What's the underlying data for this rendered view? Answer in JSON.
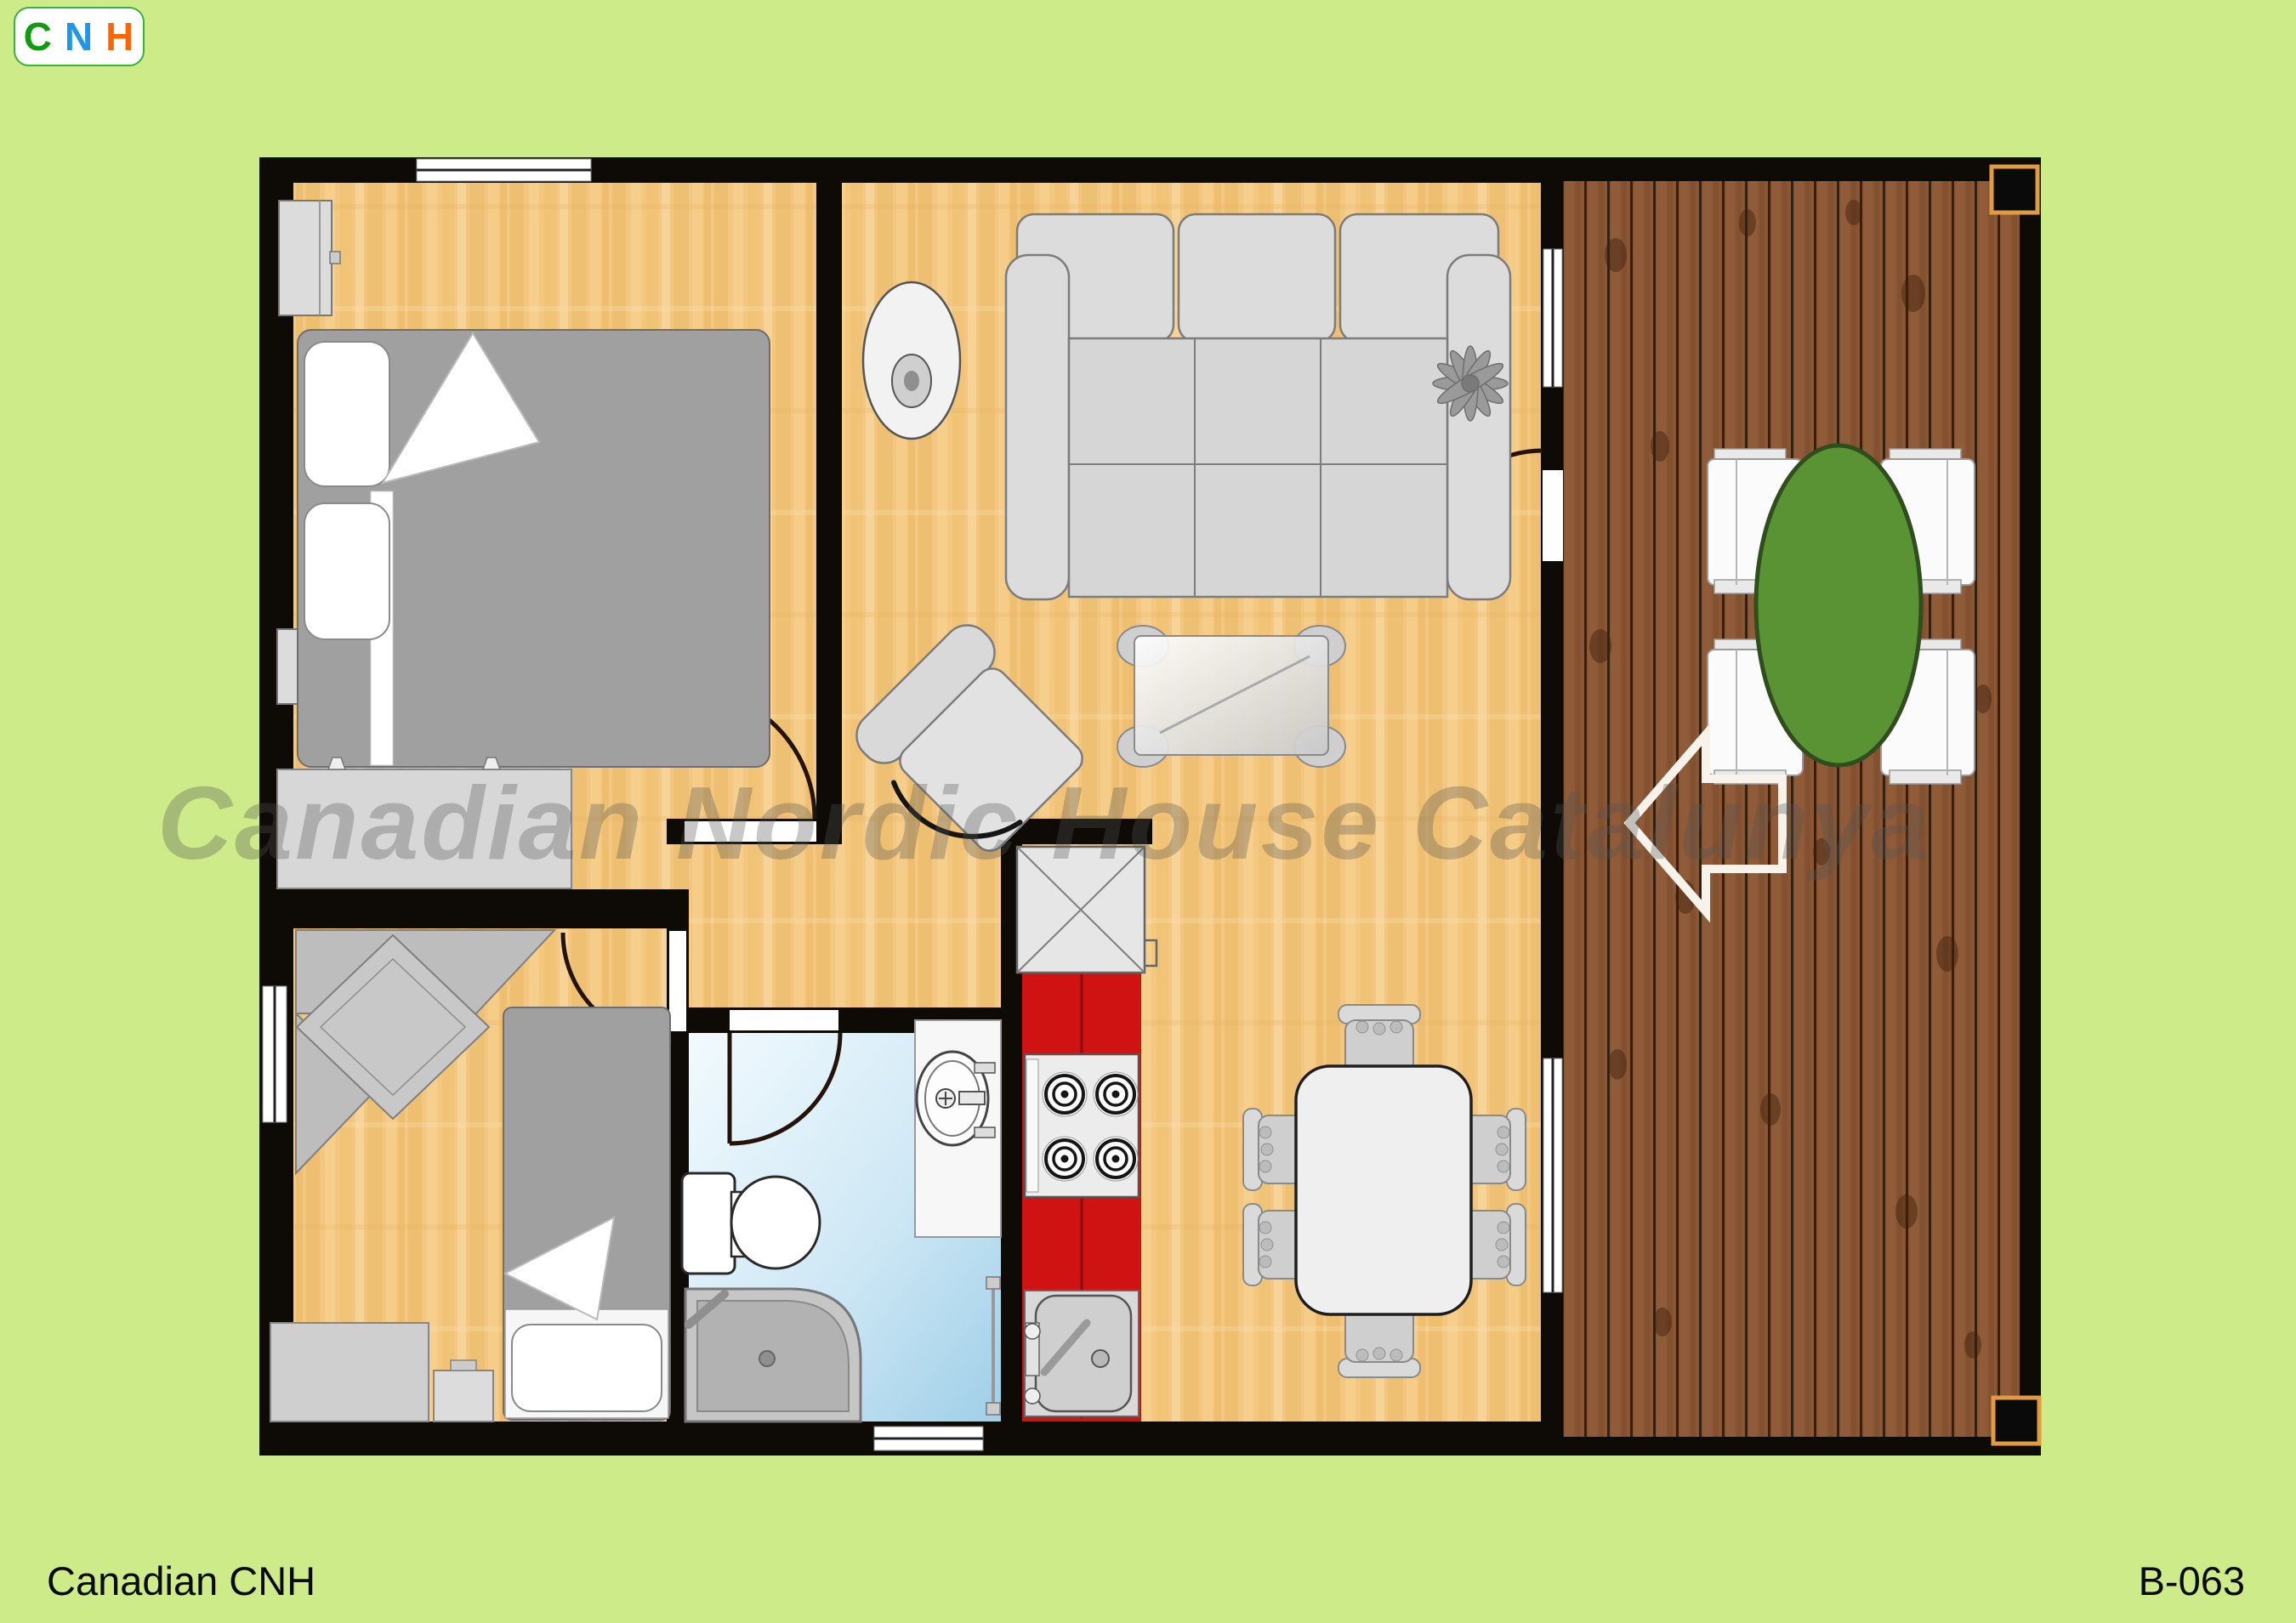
{
  "logo": {
    "letter_c": "C",
    "letter_n": "N",
    "letter_h": "H",
    "colors": {
      "c": "#0f9c0f",
      "n": "#2196e8",
      "h": "#ff6600",
      "border": "#37b337"
    }
  },
  "watermark": {
    "text": "Canadian Nordic House Catalunya"
  },
  "footer": {
    "left_label": "Canadian CNH",
    "right_label": "B-063"
  },
  "palette": {
    "lawn": "#cdeb89",
    "wall": "#0e0b07",
    "interior_wood_floor": "#f3c77f",
    "deck_wood": "#8a5736",
    "kitchen_counter_red": "#cf1212",
    "bathroom_floor_blue": "#bfe0f2",
    "outdoor_table_green": "#5a9334",
    "furniture_gray": "#d6d6d6"
  },
  "floorplan": {
    "plan_code": "B-063",
    "rooms": [
      {
        "name": "bedroom-1",
        "furniture": [
          "double bed",
          "two pillows",
          "nightstand",
          "nightstand",
          "dresser"
        ]
      },
      {
        "name": "bedroom-2",
        "furniture": [
          "single bed",
          "corner desk unit",
          "dresser",
          "nightstand"
        ]
      },
      {
        "name": "living-room",
        "furniture": [
          "three-seat sofa",
          "armchair",
          "glass coffee table",
          "round disc",
          "plant"
        ]
      },
      {
        "name": "dining-area",
        "furniture": [
          "dining table",
          "six chairs"
        ]
      },
      {
        "name": "kitchen",
        "furniture": [
          "refrigerator cabinet",
          "four-burner stove",
          "sink",
          "red counter"
        ]
      },
      {
        "name": "bathroom",
        "furniture": [
          "toilet",
          "vanity with sink",
          "corner shower",
          "towel rail"
        ]
      },
      {
        "name": "deck",
        "furniture": [
          "green oval table",
          "four white chairs",
          "entrance arrow",
          "two corner posts"
        ]
      }
    ]
  }
}
